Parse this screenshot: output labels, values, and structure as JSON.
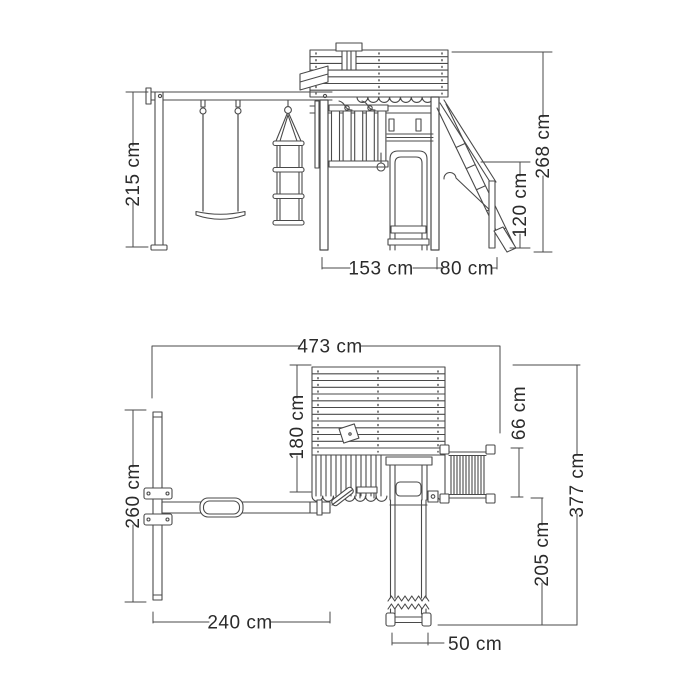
{
  "document": {
    "type": "technical-dimension-drawing",
    "subject": "wooden playset with swing, climbing tower, slide and stairs",
    "unit": "cm"
  },
  "side_view": {
    "name": "side elevation",
    "dims": {
      "swing_frame_height": "215 cm",
      "total_height": "268 cm",
      "stairs_height": "120 cm",
      "tower_width": "153 cm",
      "stairs_depth": "80 cm"
    }
  },
  "plan_view": {
    "name": "top plan view",
    "dims": {
      "total_width": "473 cm",
      "tower_depth": "180 cm",
      "stairs_width": "66 cm",
      "total_depth": "377 cm",
      "slide_length": "205 cm",
      "swing_frame_depth": "260 cm",
      "swing_beam_length": "240 cm",
      "slide_width": "50 cm"
    }
  },
  "colors": {
    "line": "#4a4a4a",
    "text": "#2b2b2b",
    "background": "#ffffff"
  }
}
